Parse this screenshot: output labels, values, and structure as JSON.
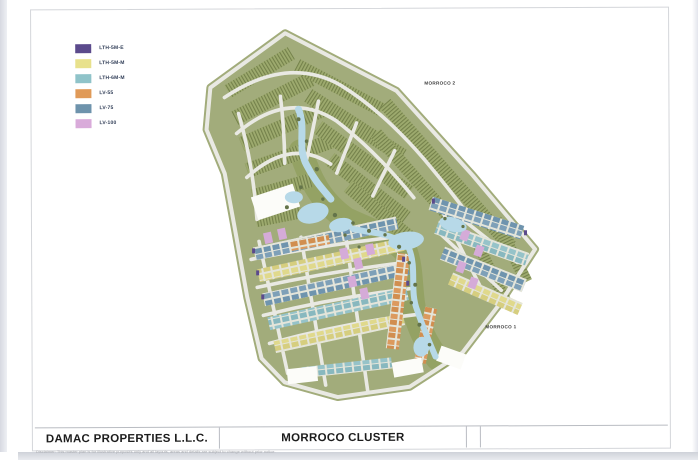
{
  "legend": {
    "items": [
      {
        "label": "LTH-5M-E",
        "color": "#5B4A8C"
      },
      {
        "label": "LTH-5M-M",
        "color": "#E8E18C"
      },
      {
        "label": "LTH-6M-M",
        "color": "#8FC3C9"
      },
      {
        "label": "LV-55",
        "color": "#E09A58"
      },
      {
        "label": "LV-75",
        "color": "#6E93AC"
      },
      {
        "label": "LV-100",
        "color": "#D9ABDA"
      }
    ]
  },
  "map": {
    "labels": {
      "area_top": "MORROCO 2",
      "area_bottom": "MORROCO 1"
    },
    "colors": {
      "landscape": "#A2AC7B",
      "road": "#E9E9E3",
      "water": "#B7D9E8"
    }
  },
  "title_block": {
    "company": "DAMAC PROPERTIES L.L.C.",
    "title": "MORROCO CLUSTER"
  },
  "fine_print": "Disclaimer: This master plan is for illustrative purposes only and all layouts, areas and details are subject to change without prior notice."
}
